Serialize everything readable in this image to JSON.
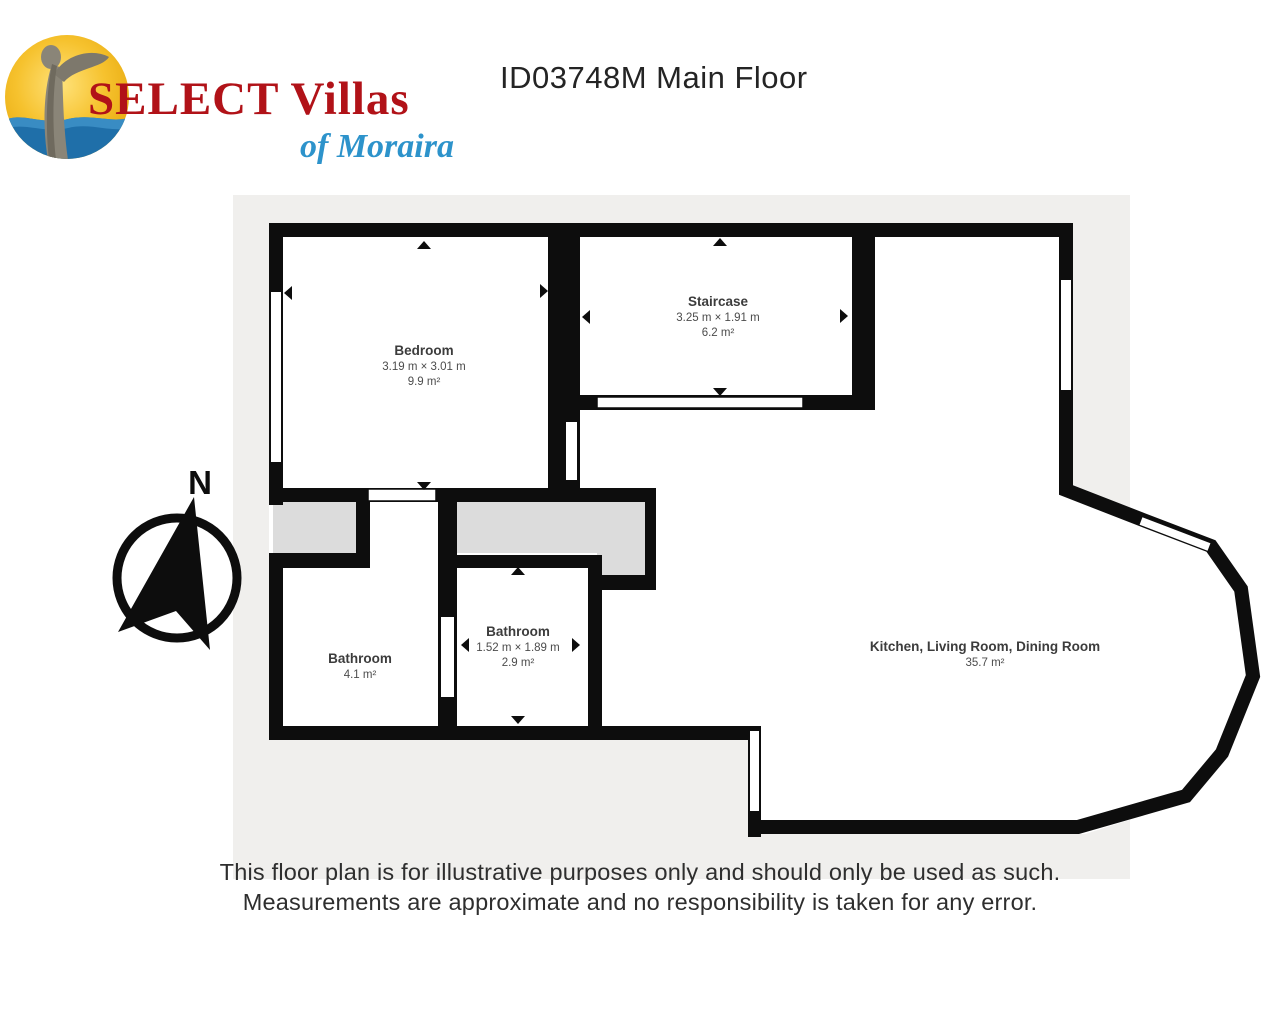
{
  "header": {
    "brand": "SELECT Villas",
    "brand_tagline": "of Moraira",
    "title": "ID03748M Main Floor",
    "brand_color": "#b11218",
    "tagline_color": "#2d93cb"
  },
  "logo": {
    "sun_color": "#f2b71c",
    "sea_color": "#1f6fa9",
    "statue_color": "#8a8578"
  },
  "floorplan": {
    "compass_label": "N",
    "colors": {
      "wall": "#0d0d0d",
      "background": "#f0efed",
      "hall": "#dcdcdc",
      "room_fill": "#ffffff"
    },
    "rooms": [
      {
        "name": "Bedroom",
        "dimensions": "3.19 m × 3.01 m",
        "area": "9.9 m²"
      },
      {
        "name": "Staircase",
        "dimensions": "3.25 m × 1.91 m",
        "area": "6.2 m²"
      },
      {
        "name": "Bathroom",
        "area": "4.1 m²"
      },
      {
        "name": "Bathroom",
        "dimensions": "1.52 m × 1.89 m",
        "area": "2.9 m²"
      },
      {
        "name": "Kitchen, Living Room, Dining Room",
        "area": "35.7 m²"
      }
    ]
  },
  "footer": {
    "disclaimer_line1": "This floor plan is for illustrative purposes only and should only be used as such.",
    "disclaimer_line2": "Measurements are approximate and no responsibility is taken for any error."
  }
}
